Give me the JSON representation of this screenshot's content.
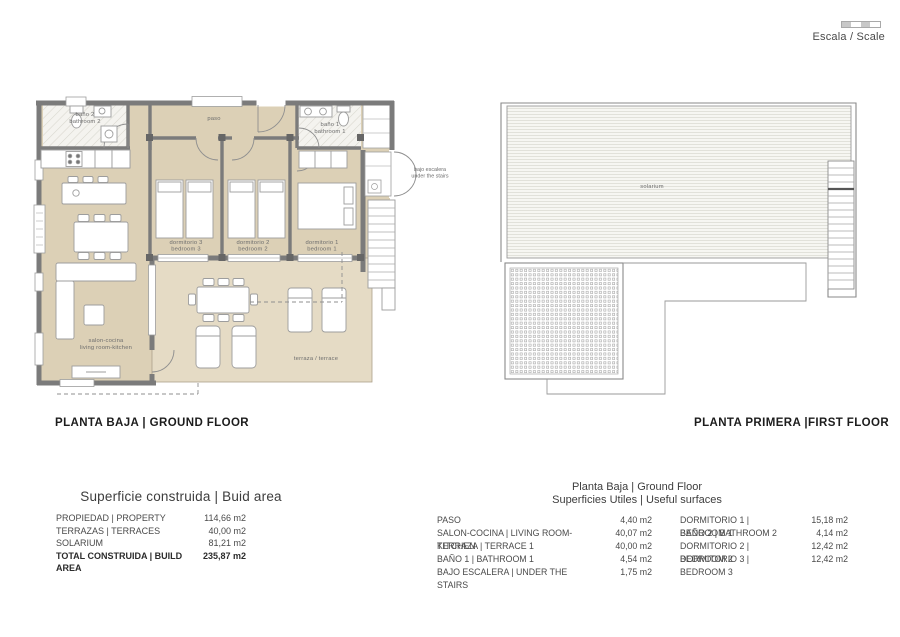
{
  "scale": {
    "label": "Escala / Scale"
  },
  "colors": {
    "interior": "#dcd0b6",
    "terrace": "#e5dbc5",
    "wall": "#7b7b7b",
    "hatch": "#d8d6ce"
  },
  "ground_floor": {
    "title": "PLANTA BAJA | GROUND FLOOR",
    "labels": {
      "bano2_l1": "baño 2",
      "bano2_l2": "bathroom 2",
      "paso": "paso",
      "bano1_l1": "baño 1",
      "bano1_l2": "bathroom 1",
      "dorm3_l1": "dormitorio 3",
      "dorm3_l2": "bedroom 3",
      "dorm2_l1": "dormitorio 2",
      "dorm2_l2": "bedroom 2",
      "dorm1_l1": "dormitorio 1",
      "dorm1_l2": "bedroom 1",
      "salon_l1": "salon-cocina",
      "salon_l2": "living room-kitchen",
      "terraza": "terraza / terrace",
      "bajo_l1": "bajo escalera",
      "bajo_l2": "under the stairs"
    }
  },
  "first_floor": {
    "title": "PLANTA PRIMERA |FIRST FLOOR",
    "labels": {
      "solarium": "solarium"
    }
  },
  "build_area_table": {
    "title": "Superficie construida | Buid area",
    "rows": [
      {
        "label": "PROPIEDAD | PROPERTY",
        "value": "114,66 m2"
      },
      {
        "label": "TERRAZAS | TERRACES",
        "value": "40,00 m2"
      },
      {
        "label": "SOLARIUM",
        "value": "81,21 m2"
      },
      {
        "label": "TOTAL CONSTRUIDA | BUILD AREA",
        "value": "235,87 m2"
      }
    ]
  },
  "useful_surfaces_table": {
    "title_line1": "Planta Baja | Ground Floor",
    "title_line2": "Superficies Utiles | Useful surfaces",
    "left_rows": [
      {
        "label": "PASO",
        "value": "4,40 m2"
      },
      {
        "label": "SALON-COCINA | LIVING ROOM-KITCHEN",
        "value": "40,07 m2"
      },
      {
        "label": "TERRAZA | TERRACE 1",
        "value": "40,00 m2"
      },
      {
        "label": "BAÑO 1 | BATHROOM 1",
        "value": "4,54 m2"
      },
      {
        "label": "BAJO ESCALERA | UNDER THE STAIRS",
        "value": "1,75 m2"
      }
    ],
    "right_rows": [
      {
        "label": "DORMITORIO 1 | BEDROOM 1",
        "value": "15,18 m2"
      },
      {
        "label": "BAÑO 2 | BATHROOM 2",
        "value": "4,14 m2"
      },
      {
        "label": "DORMITORIO 2 | BEDROOM 2",
        "value": "12,42 m2"
      },
      {
        "label": "DORMITORIO 3 | BEDROOM 3",
        "value": "12,42 m2"
      }
    ]
  }
}
